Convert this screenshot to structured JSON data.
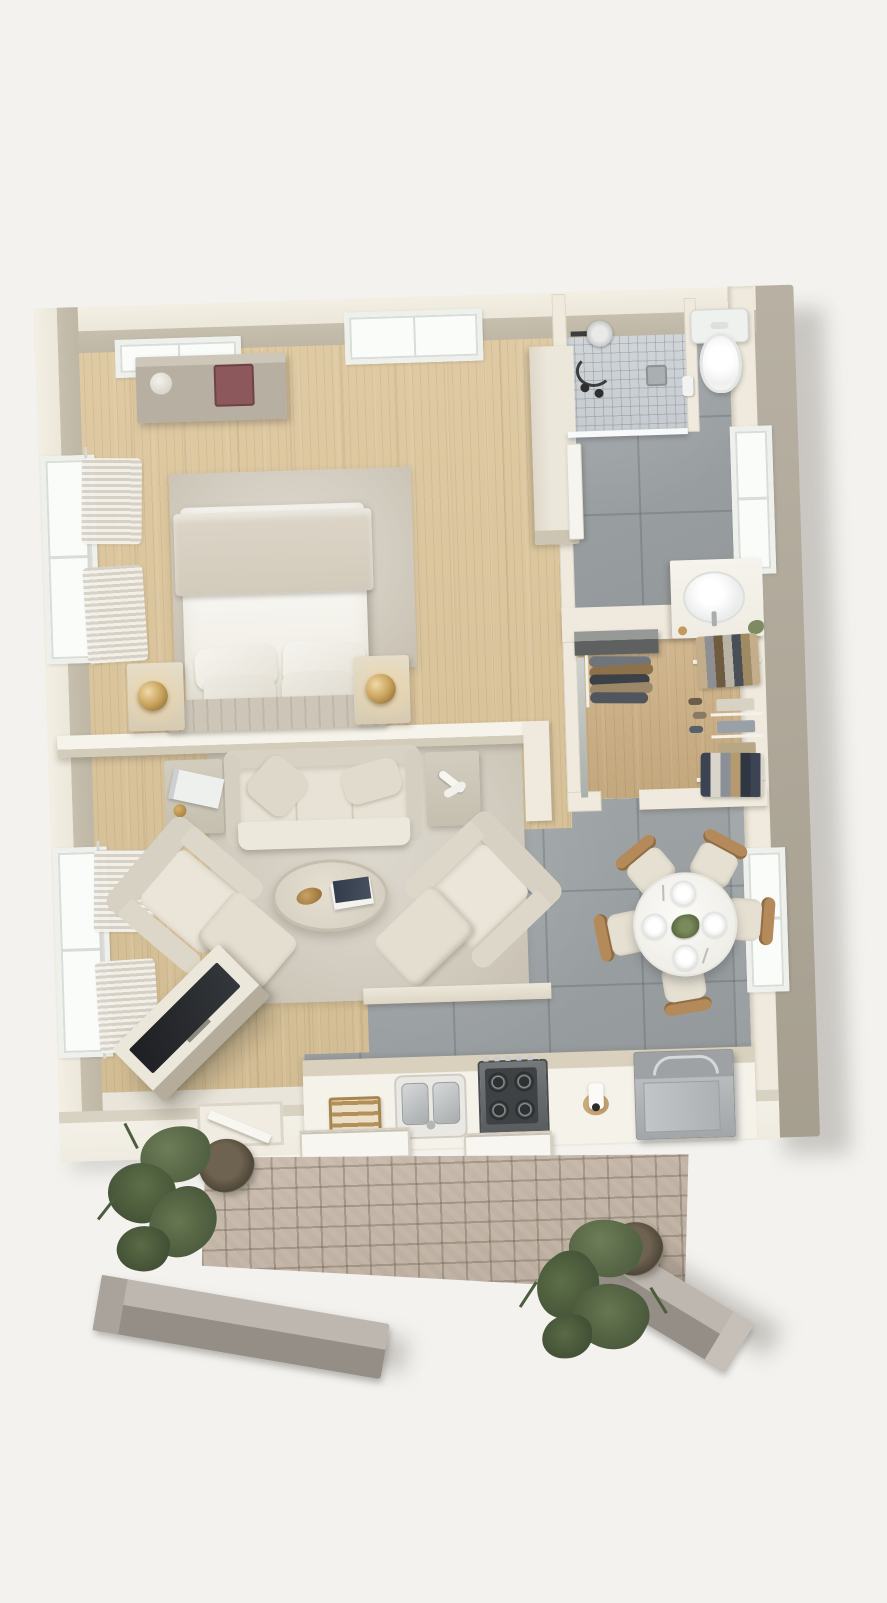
{
  "meta": {
    "title": "Top-down 3D floor plan render of a one-bedroom apartment with patio",
    "view": "bird's-eye axonometric",
    "canvas": {
      "width": 887,
      "height": 1590
    },
    "visible_text": "none"
  },
  "palette": {
    "background": "#f3f2ef",
    "wall_cream": "#efeadd",
    "wall_inner_face": "#c2bAA8",
    "wall_side_face": "#b2ab9d",
    "wood_floor": "#d8c39a",
    "closet_wood": "#c9ae85",
    "gray_tile": "#9aa0a3",
    "shower_tile": "#cdd2d5",
    "rug": "#d5cfc4",
    "upholstery_cream": "#e7e2d6",
    "stone_paving": "#c2b4a5",
    "stainless": "#aeb1b3",
    "tv_screen": "#24262a",
    "accent_red_box": "#8d585b",
    "brass_gold": "#c19a5c",
    "plant_green": "#54663f",
    "white_fixture": "#f6f5f1"
  },
  "rooms": {
    "bedroom": {
      "name": "Bedroom",
      "floor": "light oak planks",
      "items": [
        "double bed with white duvet and beige throw",
        "four white pillows",
        "tufted foot bench",
        "left nightstand with brass lamp",
        "right nightstand with brass lamp",
        "area rug",
        "wall cabinet with red keepsake box and white vase",
        "window with sheer curtains",
        "ceiling hatch window",
        "top-wall window"
      ]
    },
    "living_room": {
      "name": "Living room",
      "floor": "light oak planks",
      "items": [
        "three-seat sofa with two cushions",
        "left side table with books",
        "right side table with white sculpture",
        "oval coffee table with books and gold decor",
        "left armchair",
        "right armchair",
        "two ottomans",
        "angled TV sideboard with flat TV",
        "large area rug",
        "window with sheer curtains"
      ]
    },
    "bathroom": {
      "name": "Bathroom",
      "floor": "large gray tiles",
      "items": [
        "walk-in shower with mosaic floor",
        "shower fixture and hose",
        "floor drain",
        "glass shower screen",
        "toilet",
        "toilet-paper holder",
        "vanity with oval basin and faucet",
        "small plant",
        "door leaf",
        "window"
      ]
    },
    "closet": {
      "name": "Walk-in closet",
      "floor": "oak planks",
      "items": [
        "mirror",
        "dark dresser",
        "hanging clothes on rail",
        "upper clothes rail",
        "lower clothes rail",
        "folded clothes shelves",
        "shoes"
      ]
    },
    "dining": {
      "name": "Dining area",
      "floor": "large gray tiles",
      "items": [
        "round white table",
        "four place settings with cutlery",
        "green centerpiece",
        "five wood-frame chairs",
        "window"
      ]
    },
    "kitchen": {
      "name": "Kitchen",
      "floor": "gray concrete tiles",
      "items": [
        "white counter run",
        "spice rack",
        "double stainless sink with faucet",
        "four-burner gas hob",
        "grinder",
        "stainless appliance box"
      ]
    },
    "hallway": {
      "name": "Hallway",
      "items": [
        "tall cream cabinet"
      ]
    },
    "patio": {
      "name": "Patio",
      "items": [
        "cobblestone paving",
        "round planter with shrub (upper)",
        "round planter with shrub (lower)",
        "gray timber beam (left)",
        "gray timber beam (right)",
        "sliding-door tracks",
        "entry door leaf"
      ]
    }
  }
}
